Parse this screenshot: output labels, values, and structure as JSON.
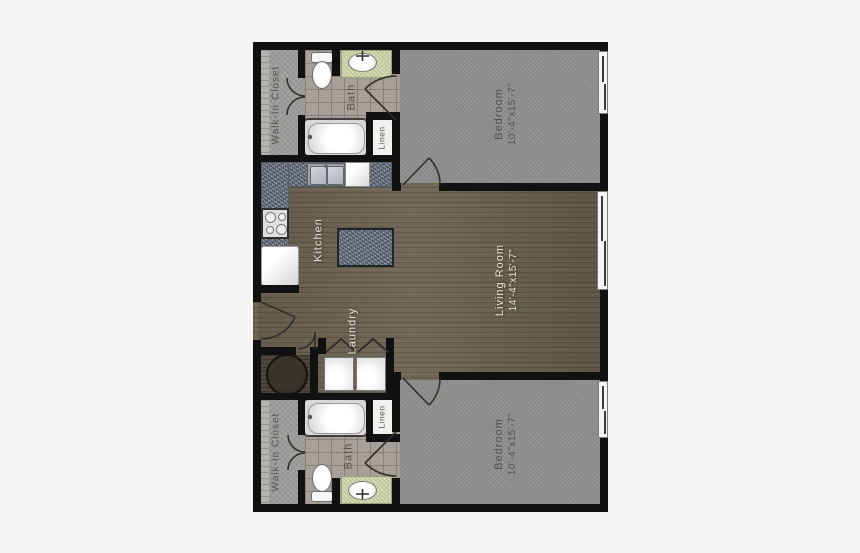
{
  "floor_plan": {
    "background_color": "#f5f5f5",
    "wall_color": "#111111",
    "rooms": {
      "walk_in_closet_top": {
        "label": "Walk-In Closet"
      },
      "bath_top": {
        "label": "Bath"
      },
      "linen_top": {
        "label": "Linen"
      },
      "bedroom_top": {
        "label": "Bedroom",
        "dimensions": "10'-4\"x15'-7\""
      },
      "kitchen": {
        "label": "Kitchen"
      },
      "living_room": {
        "label": "Living Room",
        "dimensions": "14'-4\"x15'-7\""
      },
      "laundry": {
        "label": "Laundry"
      },
      "linen_bottom": {
        "label": "Linen"
      },
      "bath_bottom": {
        "label": "Bath"
      },
      "walk_in_closet_bottom": {
        "label": "Walk-In Closet"
      },
      "bedroom_bottom": {
        "label": "Bedroom",
        "dimensions": "10'-4\"x15'-7\""
      }
    },
    "floor_colors": {
      "bedroom_carpet": "#8f8f8f",
      "closet_carpet": "#9d9c9a",
      "bath_tile": "#a7a099",
      "hardwood": "#6b6150",
      "granite_counter": "#7b8491",
      "vanity_counter": "#cdd3a8"
    },
    "fixtures": {
      "toilet": "toilet",
      "vanity_sink": "vanity-sink",
      "bathtub": "bathtub",
      "kitchen_sink": "double-basin-sink",
      "dishwasher": "dishwasher",
      "range": "range-cooktop",
      "refrigerator": "refrigerator",
      "island": "kitchen-island",
      "washer": "washer",
      "dryer": "dryer",
      "water_heater": "water-heater"
    }
  }
}
